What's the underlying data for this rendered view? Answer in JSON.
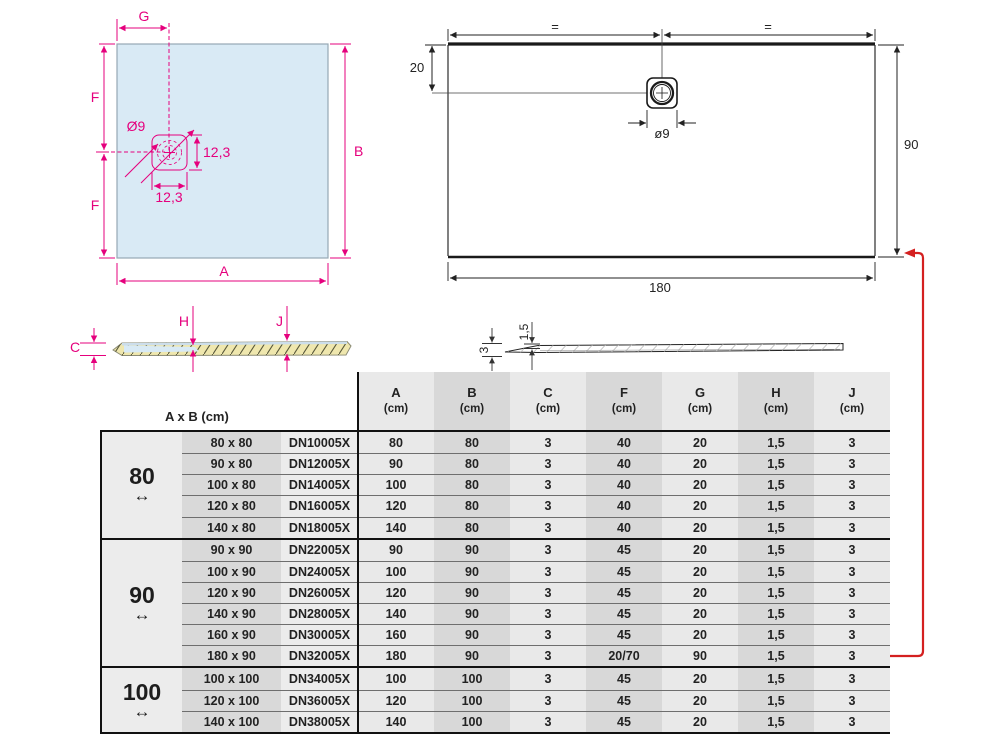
{
  "colors": {
    "magenta": "#e5007d",
    "tray_fill": "#d9eaf5",
    "line_black": "#222222",
    "red_arrow": "#d42020",
    "hatch_yellow": "#efe7ae",
    "water_blue": "#d8eaf5",
    "table_shade_light": "#e9e9e9",
    "table_shade_dark": "#d8d8d8"
  },
  "square_diagram": {
    "g": "G",
    "f_top": "F",
    "f_bottom": "F",
    "a": "A",
    "b": "B",
    "drain_diameter": "Ø9",
    "drain_height": "12,3",
    "drain_width": "12,3"
  },
  "rect_diagram": {
    "eq_left": "=",
    "eq_right": "=",
    "offset_top": "20",
    "drain_diameter": "ø9",
    "width": "180",
    "height": "90"
  },
  "section_a": {
    "c": "C",
    "h": "H",
    "j": "J"
  },
  "section_b": {
    "height": "3",
    "lip": "1,5"
  },
  "table": {
    "ab_header": "A x B (cm)",
    "unit": "(cm)",
    "columns": [
      "A",
      "B",
      "C",
      "F",
      "G",
      "H",
      "J"
    ],
    "groups": [
      {
        "width": "80",
        "arrow": "↔",
        "rows": [
          {
            "dim": "80 x 80",
            "code": "DN10005X",
            "values": [
              "80",
              "80",
              "3",
              "40",
              "20",
              "1,5",
              "3"
            ]
          },
          {
            "dim": "90 x 80",
            "code": "DN12005X",
            "values": [
              "90",
              "80",
              "3",
              "40",
              "20",
              "1,5",
              "3"
            ]
          },
          {
            "dim": "100 x 80",
            "code": "DN14005X",
            "values": [
              "100",
              "80",
              "3",
              "40",
              "20",
              "1,5",
              "3"
            ]
          },
          {
            "dim": "120 x 80",
            "code": "DN16005X",
            "values": [
              "120",
              "80",
              "3",
              "40",
              "20",
              "1,5",
              "3"
            ]
          },
          {
            "dim": "140 x 80",
            "code": "DN18005X",
            "values": [
              "140",
              "80",
              "3",
              "40",
              "20",
              "1,5",
              "3"
            ]
          }
        ]
      },
      {
        "width": "90",
        "arrow": "↔",
        "rows": [
          {
            "dim": "90 x 90",
            "code": "DN22005X",
            "values": [
              "90",
              "90",
              "3",
              "45",
              "20",
              "1,5",
              "3"
            ]
          },
          {
            "dim": "100 x 90",
            "code": "DN24005X",
            "values": [
              "100",
              "90",
              "3",
              "45",
              "20",
              "1,5",
              "3"
            ]
          },
          {
            "dim": "120 x 90",
            "code": "DN26005X",
            "values": [
              "120",
              "90",
              "3",
              "45",
              "20",
              "1,5",
              "3"
            ]
          },
          {
            "dim": "140 x 90",
            "code": "DN28005X",
            "values": [
              "140",
              "90",
              "3",
              "45",
              "20",
              "1,5",
              "3"
            ]
          },
          {
            "dim": "160 x 90",
            "code": "DN30005X",
            "values": [
              "160",
              "90",
              "3",
              "45",
              "20",
              "1,5",
              "3"
            ]
          },
          {
            "dim": "180 x 90",
            "code": "DN32005X",
            "values": [
              "180",
              "90",
              "3",
              "20/70",
              "90",
              "1,5",
              "3"
            ],
            "highlight": true
          }
        ]
      },
      {
        "width": "100",
        "arrow": "↔",
        "rows": [
          {
            "dim": "100 x 100",
            "code": "DN34005X",
            "values": [
              "100",
              "100",
              "3",
              "45",
              "20",
              "1,5",
              "3"
            ]
          },
          {
            "dim": "120 x 100",
            "code": "DN36005X",
            "values": [
              "120",
              "100",
              "3",
              "45",
              "20",
              "1,5",
              "3"
            ]
          },
          {
            "dim": "140 x 100",
            "code": "DN38005X",
            "values": [
              "140",
              "100",
              "3",
              "45",
              "20",
              "1,5",
              "3"
            ]
          }
        ]
      }
    ]
  }
}
